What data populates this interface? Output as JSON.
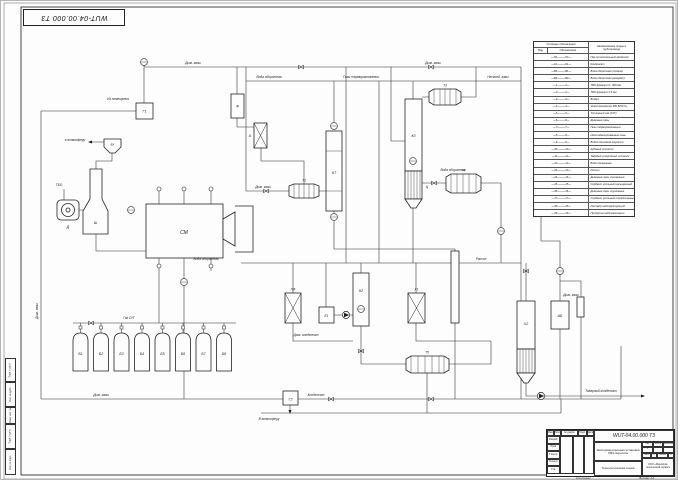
{
  "sheet": {
    "doc_number_stamp": "WUT-04.00.000 Т3",
    "copied_label": "Копировал",
    "format_label": "Формат",
    "format_value": "А1",
    "line_color": "#2b2b2b"
  },
  "legend": {
    "header_group": "Условные обозначения",
    "col_kind": "Вид",
    "col_designation": "Обозначение",
    "col_name": "Наименование среды в трубопроводе",
    "rows": [
      {
        "code": "П1",
        "name": "Пар отопительный (водяной)"
      },
      {
        "code": "К1",
        "name": "Конденсат"
      },
      {
        "code": "В1",
        "name": "Вода оборотная (подача)"
      },
      {
        "code": "В2",
        "name": "Вода оборотная (возврат)"
      },
      {
        "code": "1",
        "name": "ТБО фракция 0...300 мм"
      },
      {
        "code": "2",
        "name": "ТБО фракция 1,5 мм"
      },
      {
        "code": "3",
        "name": "Воздух"
      },
      {
        "code": "4",
        "name": "Электроэнергия 380 В/50 Гц"
      },
      {
        "code": "5",
        "name": "Топливный газ (СУГ)"
      },
      {
        "code": "6",
        "name": "Дымовые газы"
      },
      {
        "code": "7",
        "name": "Газы терморазложения"
      },
      {
        "code": "8",
        "name": "Несконденсированные газы"
      },
      {
        "code": "9",
        "name": "Водно-смоляная эмульсия"
      },
      {
        "code": "10",
        "name": "Кубовый остаток"
      },
      {
        "code": "11",
        "name": "Твёрдый углеродный остаток"
      },
      {
        "code": "12",
        "name": "Вода промывная"
      },
      {
        "code": "13",
        "name": "Рассол"
      },
      {
        "code": "14",
        "name": "Дымовые газы очищенные"
      },
      {
        "code": "15",
        "name": "Сорбент угольный насыщенный"
      },
      {
        "code": "16",
        "name": "Дымовые газы осушенные"
      },
      {
        "code": "17",
        "name": "Сорбент угольный отработанный"
      },
      {
        "code": "18",
        "name": "Раствор нейтрализующий"
      },
      {
        "code": "19",
        "name": "Продукты нейтрализации"
      }
    ]
  },
  "title_block": {
    "doc_number": "WUT-04.00.000 Т3",
    "project_title": "Экспериментальная установка СВЧ-пиролиза",
    "doc_type": "Технологическая схема",
    "organization": "ООО «Машпром-технический сервис»",
    "izm": "Изм.",
    "list_col": "Лист",
    "doc_col": "№ докум.",
    "sign_col": "Подп.",
    "date_col": "Дата",
    "razrab": "Разраб.",
    "prov": "Пров.",
    "tkontr": "Т.контр.",
    "nkontr": "Н.контр.",
    "utv": "Утв.",
    "lit_label": "Лит.",
    "mass_label": "Масса",
    "scale_label": "Масштаб",
    "lit_value": "У",
    "sheet_label": "Лист",
    "sheet_value": "1",
    "sheets_label": "Листов",
    "sheets_value": "1"
  },
  "margin_labels": {
    "b1": "Подп. и дата",
    "b2": "Инв. № дубл.",
    "b3": "Взам. инв. №",
    "b4": "Подп. и дата",
    "b5": "Инв. № подл."
  },
  "equipment": {
    "hopper": "БУ",
    "stack": "Ш",
    "fan": "Д",
    "reactor": "СМ",
    "g1": "Г1",
    "g2": "Г2",
    "f": "Ф",
    "a": "А",
    "kt": "КТ",
    "t1": "Т1",
    "t3": "Т3",
    "t4": "Т4",
    "t5": "Т5",
    "k2": "К2",
    "k3": "К3",
    "c": "Ц",
    "pf": "ПФ",
    "e1": "Е1",
    "x1": "Х1",
    "x2": "Х2",
    "ab": "АБ",
    "cylinders": [
      "Б1",
      "Б2",
      "Б3",
      "Б4",
      "Б5",
      "Б6",
      "Б7",
      "Б8"
    ]
  },
  "pipe_labels": [
    "Дым. газы",
    "Дым. газы",
    "Вода оборотная",
    "Газы терморазложения",
    "Дым. газы",
    "Газ СУГ",
    "Дым. газы",
    "Конденсат",
    "В атмосферу",
    "в атмосферу",
    "ТБО",
    "Из помещения",
    "Вода оборотная",
    "Рассол",
    "Дым. конденсат",
    "Товарный конденсат",
    "Несконд. газы",
    "Дым. газы",
    "Вода оборотная",
    "Дым. газы"
  ]
}
